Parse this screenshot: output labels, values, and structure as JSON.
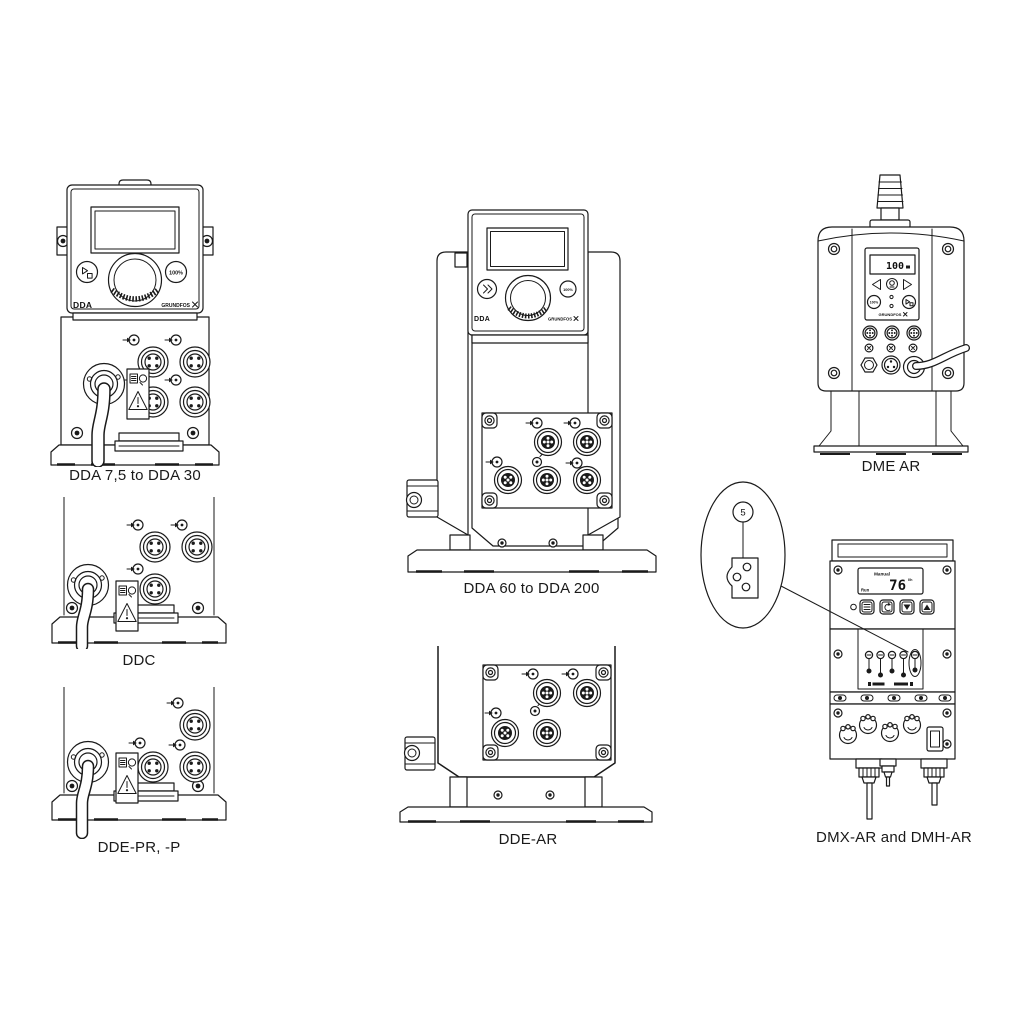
{
  "page": {
    "background": "#ffffff",
    "line_color": "#1a1a1a"
  },
  "figures": {
    "dda_small": {
      "caption": "DDA 7,5 to DDA 30",
      "panel_label": "DDA",
      "brand": "GRUNDFOS",
      "button_100": "100%"
    },
    "ddc": {
      "caption": "DDC"
    },
    "dde_pr_p": {
      "caption": "DDE-PR, -P"
    },
    "dda_large": {
      "caption": "DDA 60 to DDA 200",
      "panel_label": "DDA",
      "brand": "GRUNDFOS",
      "button_100": "100%"
    },
    "dde_ar": {
      "caption": "DDE-AR"
    },
    "dme_ar": {
      "caption": "DME AR",
      "display_value": "100",
      "brand": "GRUNDFOS",
      "button_100": "100%"
    },
    "dmx_dmh": {
      "caption": "DMX-AR and DMH-AR",
      "display_mode": "Manual",
      "display_value": "76",
      "display_unit": "l/h",
      "display_status": "Run"
    },
    "callout": {
      "number": "5"
    }
  }
}
